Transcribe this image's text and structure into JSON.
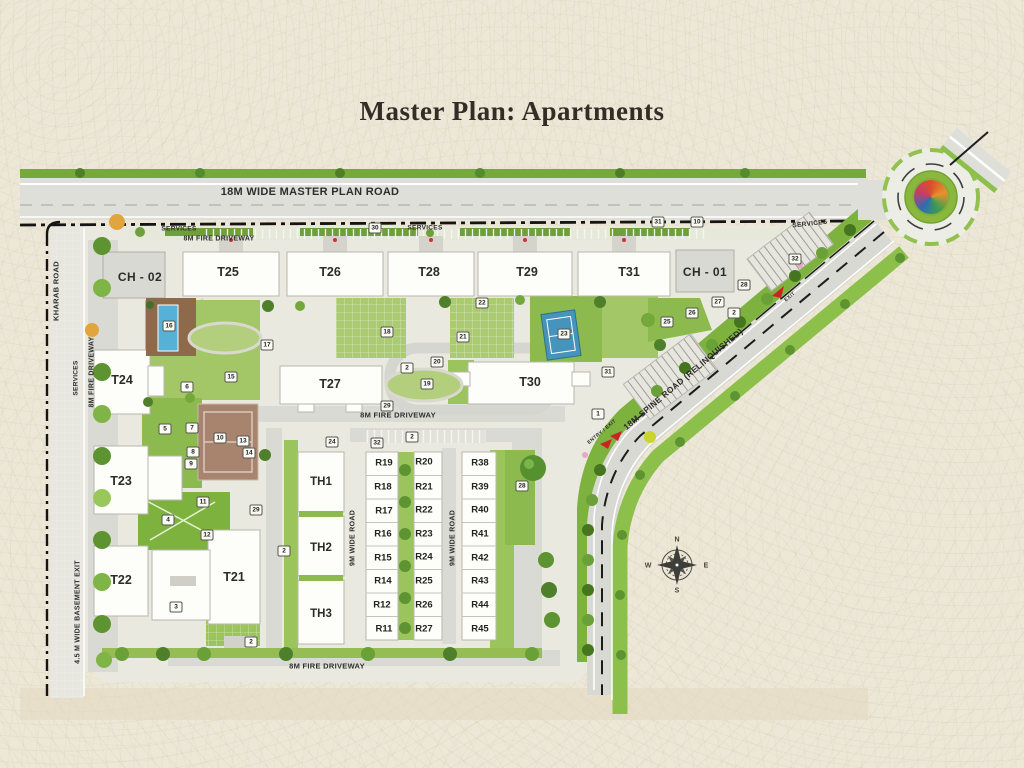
{
  "title": "Master Plan: Apartments",
  "colors": {
    "background": "#ece7d7",
    "green_primary": "#8ab845",
    "green_light": "#a9ca72",
    "road_gray": "#dcdcd6",
    "building_white": "#fdfdf9",
    "clubhouse_gray": "#d9d9d3",
    "boundary_black": "#141414",
    "pool_blue": "#55b2d6",
    "court_brown": "#a8836e",
    "accent_red": "#cc2222"
  },
  "plan": {
    "buildings": {
      "towers": [
        {
          "label": "CH - 02",
          "kind": "clubhouse",
          "x": 140,
          "y": 277
        },
        {
          "label": "T25",
          "kind": "tower",
          "x": 228,
          "y": 272
        },
        {
          "label": "T26",
          "kind": "tower",
          "x": 330,
          "y": 272
        },
        {
          "label": "T28",
          "kind": "tower",
          "x": 429,
          "y": 272
        },
        {
          "label": "T29",
          "kind": "tower",
          "x": 527,
          "y": 272
        },
        {
          "label": "T31",
          "kind": "tower",
          "x": 629,
          "y": 272
        },
        {
          "label": "CH - 01",
          "kind": "clubhouse",
          "x": 705,
          "y": 272
        },
        {
          "label": "T24",
          "kind": "tower",
          "x": 122,
          "y": 380
        },
        {
          "label": "T27",
          "kind": "tower",
          "x": 330,
          "y": 384
        },
        {
          "label": "T30",
          "kind": "tower",
          "x": 530,
          "y": 382
        },
        {
          "label": "T23",
          "kind": "tower",
          "x": 121,
          "y": 481
        },
        {
          "label": "T22",
          "kind": "tower",
          "x": 121,
          "y": 580
        },
        {
          "label": "T21",
          "kind": "tower",
          "x": 234,
          "y": 577
        }
      ],
      "townhouses": [
        {
          "label": "TH1",
          "x": 321,
          "y": 482
        },
        {
          "label": "TH2",
          "x": 321,
          "y": 548
        },
        {
          "label": "TH3",
          "x": 321,
          "y": 614
        }
      ],
      "rowhouses": [
        {
          "label": "R19",
          "x": 384,
          "y": 463
        },
        {
          "label": "R18",
          "x": 383,
          "y": 487
        },
        {
          "label": "R17",
          "x": 384,
          "y": 511
        },
        {
          "label": "R16",
          "x": 383,
          "y": 534
        },
        {
          "label": "R15",
          "x": 383,
          "y": 558
        },
        {
          "label": "R14",
          "x": 383,
          "y": 581
        },
        {
          "label": "R12",
          "x": 382,
          "y": 605
        },
        {
          "label": "R11",
          "x": 384,
          "y": 629
        },
        {
          "label": "R20",
          "x": 424,
          "y": 462
        },
        {
          "label": "R21",
          "x": 424,
          "y": 487
        },
        {
          "label": "R22",
          "x": 424,
          "y": 510
        },
        {
          "label": "R23",
          "x": 424,
          "y": 534
        },
        {
          "label": "R24",
          "x": 424,
          "y": 557
        },
        {
          "label": "R25",
          "x": 424,
          "y": 581
        },
        {
          "label": "R26",
          "x": 424,
          "y": 605
        },
        {
          "label": "R27",
          "x": 424,
          "y": 629
        },
        {
          "label": "R38",
          "x": 480,
          "y": 463
        },
        {
          "label": "R39",
          "x": 480,
          "y": 487
        },
        {
          "label": "R40",
          "x": 480,
          "y": 510
        },
        {
          "label": "R41",
          "x": 480,
          "y": 534
        },
        {
          "label": "R42",
          "x": 480,
          "y": 558
        },
        {
          "label": "R43",
          "x": 480,
          "y": 581
        },
        {
          "label": "R44",
          "x": 480,
          "y": 605
        },
        {
          "label": "R45",
          "x": 480,
          "y": 629
        }
      ]
    },
    "road_labels": [
      {
        "id": "master-plan-road",
        "text": "18M WIDE MASTER PLAN ROAD",
        "x": 310,
        "y": 192,
        "rot": 0,
        "fs": 11
      },
      {
        "id": "services-top-left",
        "text": "SERVICES",
        "x": 179,
        "y": 229,
        "rot": 0,
        "fs": 6.5
      },
      {
        "id": "fire-driveway-top",
        "text": "8M FIRE DRIVEWAY",
        "x": 219,
        "y": 239,
        "rot": 0,
        "fs": 7
      },
      {
        "id": "services-top-mid",
        "text": "SERVICES",
        "x": 425,
        "y": 228,
        "rot": 0,
        "fs": 6.5
      },
      {
        "id": "services-top-right",
        "text": "SERVICES",
        "x": 810,
        "y": 224,
        "rot": -6,
        "fs": 6.5
      },
      {
        "id": "kharab-road",
        "text": "KHARAB ROAD",
        "x": 56,
        "y": 291,
        "rot": -90,
        "fs": 7.5
      },
      {
        "id": "services-left",
        "text": "SERVICES",
        "x": 76,
        "y": 378,
        "rot": -90,
        "fs": 6.5
      },
      {
        "id": "fire-driveway-left",
        "text": "8M FIRE DRIVEWAY",
        "x": 92,
        "y": 372,
        "rot": -90,
        "fs": 7
      },
      {
        "id": "basement-exit",
        "text": "4.5 M WIDE BASEMENT EXIT",
        "x": 78,
        "y": 612,
        "rot": -90,
        "fs": 7
      },
      {
        "id": "fire-driveway-mid",
        "text": "8M FIRE DRIVEWAY",
        "x": 398,
        "y": 415,
        "rot": 0,
        "fs": 7.5
      },
      {
        "id": "fire-driveway-bottom",
        "text": "8M FIRE DRIVEWAY",
        "x": 327,
        "y": 666,
        "rot": 0,
        "fs": 7.5
      },
      {
        "id": "nine-m-road-left",
        "text": "9M WIDE ROAD",
        "x": 353,
        "y": 538,
        "rot": -90,
        "fs": 7
      },
      {
        "id": "nine-m-road-right",
        "text": "9M WIDE ROAD",
        "x": 453,
        "y": 538,
        "rot": -90,
        "fs": 7
      },
      {
        "id": "spine-road",
        "text": "18M SPINE ROAD (RELINQUISHED)",
        "x": 683,
        "y": 379,
        "rot": -40,
        "fs": 8.5
      },
      {
        "id": "entry-exit",
        "text": "ENTRY / EXIT",
        "x": 602,
        "y": 432,
        "rot": -40,
        "fs": 5
      },
      {
        "id": "exit-top",
        "text": "EXIT",
        "x": 790,
        "y": 297,
        "rot": -40,
        "fs": 5
      }
    ],
    "markers": [
      {
        "n": "1",
        "x": 598,
        "y": 414
      },
      {
        "n": "2",
        "x": 407,
        "y": 368
      },
      {
        "n": "2",
        "x": 412,
        "y": 437
      },
      {
        "n": "2",
        "x": 284,
        "y": 551
      },
      {
        "n": "2",
        "x": 251,
        "y": 642
      },
      {
        "n": "2",
        "x": 734,
        "y": 313
      },
      {
        "n": "3",
        "x": 176,
        "y": 607
      },
      {
        "n": "4",
        "x": 168,
        "y": 520
      },
      {
        "n": "5",
        "x": 165,
        "y": 429
      },
      {
        "n": "6",
        "x": 187,
        "y": 387
      },
      {
        "n": "7",
        "x": 192,
        "y": 428
      },
      {
        "n": "8",
        "x": 193,
        "y": 452
      },
      {
        "n": "9",
        "x": 191,
        "y": 464
      },
      {
        "n": "10",
        "x": 220,
        "y": 438
      },
      {
        "n": "11",
        "x": 203,
        "y": 502
      },
      {
        "n": "12",
        "x": 207,
        "y": 535
      },
      {
        "n": "13",
        "x": 243,
        "y": 441
      },
      {
        "n": "14",
        "x": 249,
        "y": 453
      },
      {
        "n": "15",
        "x": 231,
        "y": 377
      },
      {
        "n": "16",
        "x": 169,
        "y": 326
      },
      {
        "n": "17",
        "x": 267,
        "y": 345
      },
      {
        "n": "18",
        "x": 387,
        "y": 332
      },
      {
        "n": "19",
        "x": 427,
        "y": 384
      },
      {
        "n": "20",
        "x": 437,
        "y": 362
      },
      {
        "n": "21",
        "x": 463,
        "y": 337
      },
      {
        "n": "22",
        "x": 482,
        "y": 303
      },
      {
        "n": "23",
        "x": 564,
        "y": 334
      },
      {
        "n": "24",
        "x": 332,
        "y": 442
      },
      {
        "n": "25",
        "x": 667,
        "y": 322
      },
      {
        "n": "26",
        "x": 692,
        "y": 313
      },
      {
        "n": "27",
        "x": 718,
        "y": 302
      },
      {
        "n": "28",
        "x": 744,
        "y": 285
      },
      {
        "n": "28",
        "x": 522,
        "y": 486
      },
      {
        "n": "29",
        "x": 387,
        "y": 406
      },
      {
        "n": "29",
        "x": 256,
        "y": 510
      },
      {
        "n": "30",
        "x": 375,
        "y": 228
      },
      {
        "n": "31",
        "x": 658,
        "y": 222
      },
      {
        "n": "10",
        "x": 697,
        "y": 222
      },
      {
        "n": "31",
        "x": 608,
        "y": 372
      },
      {
        "n": "32",
        "x": 795,
        "y": 259
      },
      {
        "n": "32",
        "x": 377,
        "y": 443
      }
    ],
    "compass": {
      "points": [
        {
          "t": "N",
          "x": 677,
          "y": 540
        },
        {
          "t": "E",
          "x": 706,
          "y": 566
        },
        {
          "t": "S",
          "x": 677,
          "y": 591
        },
        {
          "t": "W",
          "x": 648,
          "y": 566
        }
      ]
    }
  }
}
